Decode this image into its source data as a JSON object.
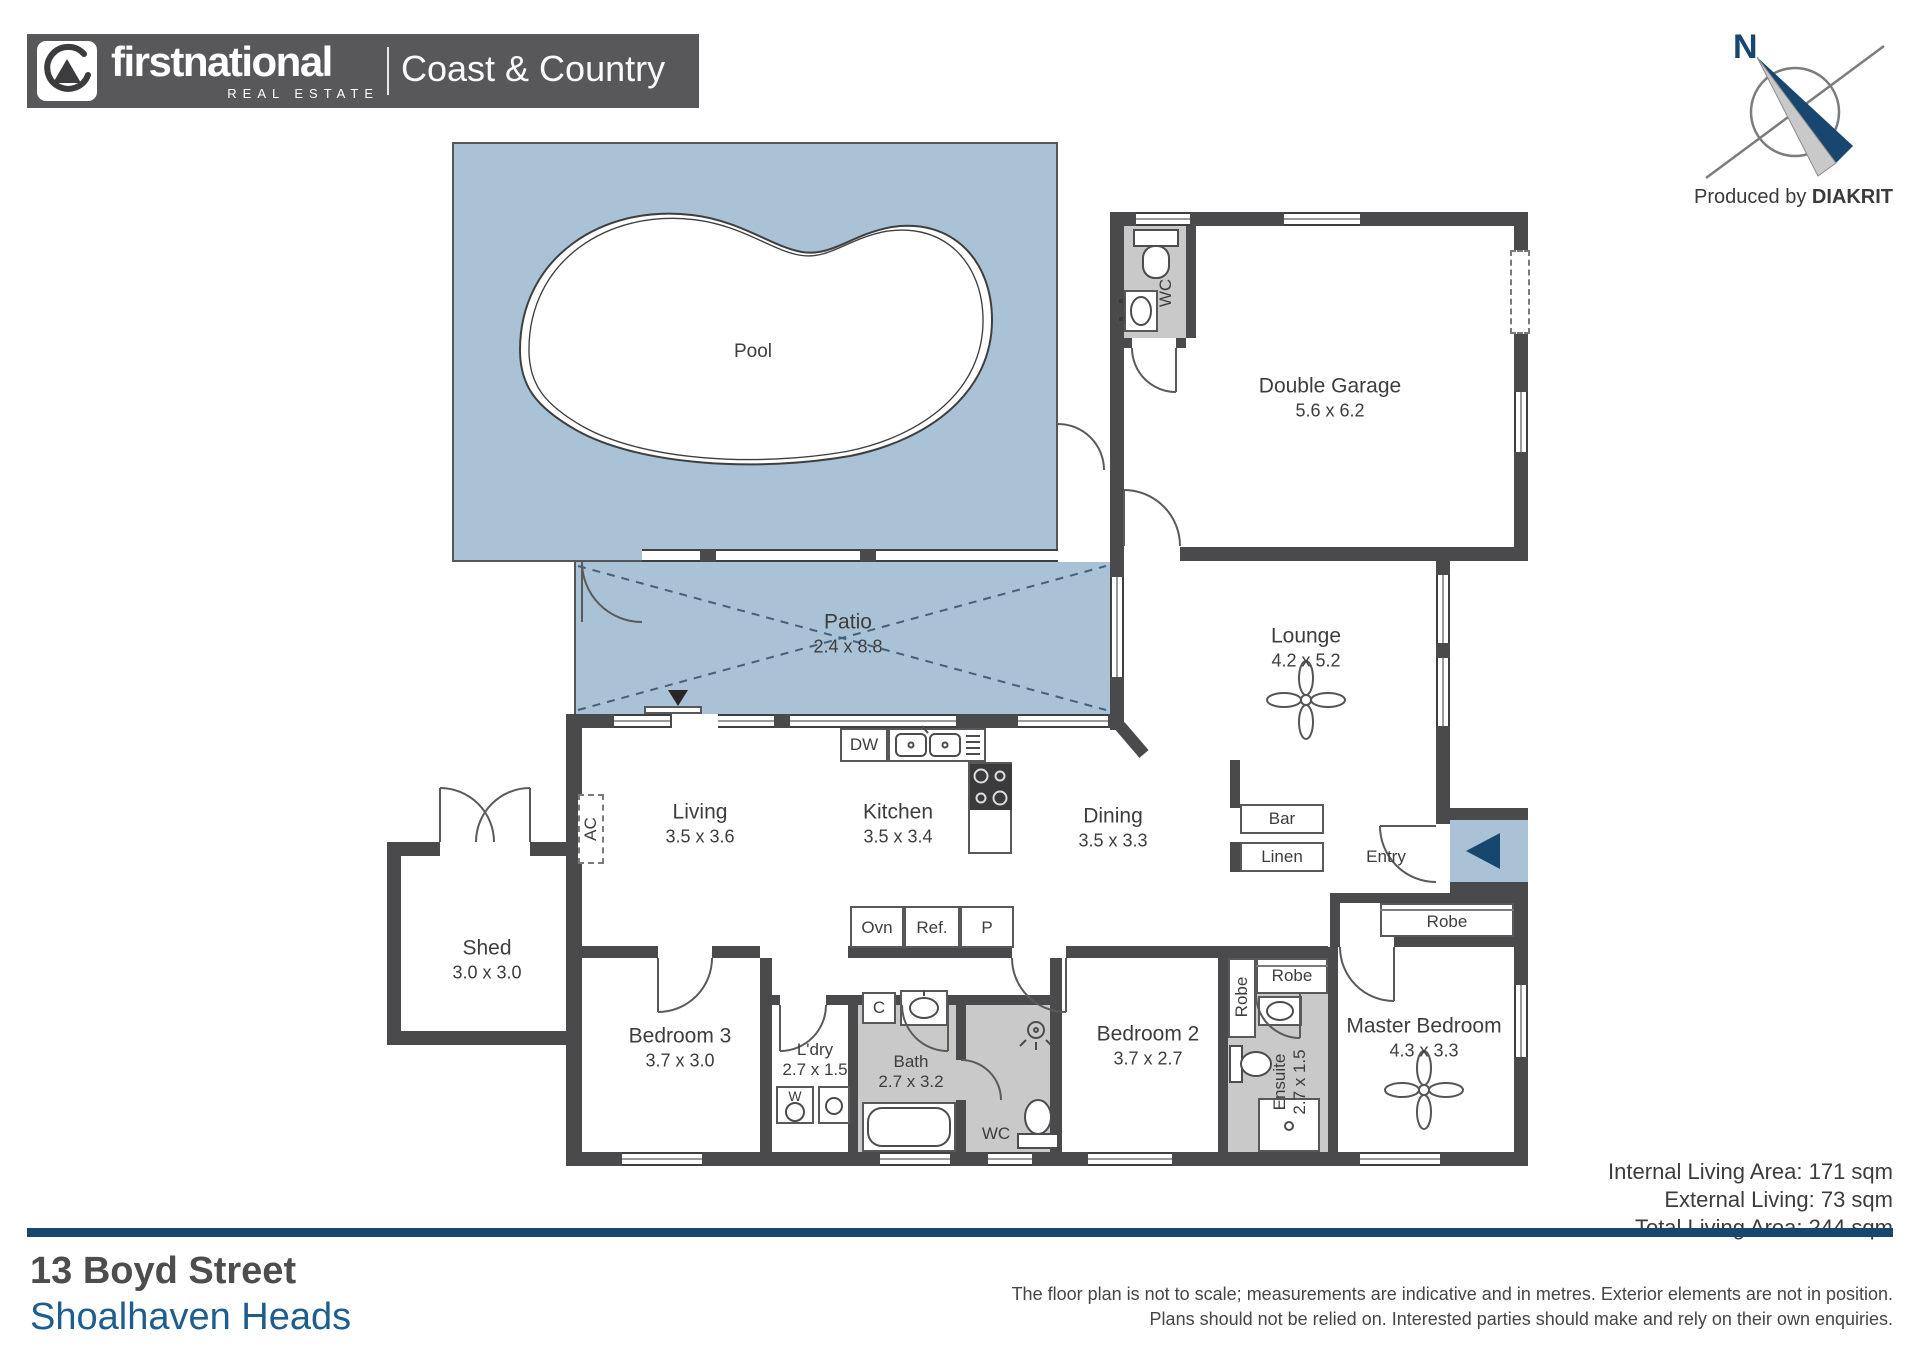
{
  "brand": {
    "name_bold": "firstnational",
    "name_sub": "REAL ESTATE",
    "office": "Coast & Country"
  },
  "compass": {
    "north": "N",
    "produced_by": "Produced by ",
    "producer": "DIAKRIT"
  },
  "plan": {
    "pool": {
      "label": "Pool"
    },
    "patio": {
      "label": "Patio",
      "dims": "2.4 x 8.8"
    },
    "garage": {
      "label": "Double Garage",
      "dims": "5.6 x 6.2"
    },
    "garage_wc": {
      "label": "WC"
    },
    "lounge": {
      "label": "Lounge",
      "dims": "4.2 x 5.2"
    },
    "living": {
      "label": "Living",
      "dims": "3.5 x 3.6"
    },
    "kitchen": {
      "label": "Kitchen",
      "dims": "3.5 x 3.4"
    },
    "dining": {
      "label": "Dining",
      "dims": "3.5 x 3.3"
    },
    "bar": {
      "label": "Bar"
    },
    "linen": {
      "label": "Linen"
    },
    "entry": {
      "label": "Entry"
    },
    "shed": {
      "label": "Shed",
      "dims": "3.0 x 3.0"
    },
    "bedroom3": {
      "label": "Bedroom 3",
      "dims": "3.7 x 3.0"
    },
    "laundry": {
      "label": "L'dry",
      "dims": "2.7 x 1.5"
    },
    "bath": {
      "label": "Bath",
      "dims": "2.7 x 3.2"
    },
    "wc": {
      "label": "WC"
    },
    "bedroom2": {
      "label": "Bedroom 2",
      "dims": "3.7 x 2.7"
    },
    "robe_bed2_side": {
      "label": "Robe"
    },
    "robe_bed2_top": {
      "label": "Robe"
    },
    "ensuite": {
      "label": "Ensuite",
      "dims": "2.7 x 1.5"
    },
    "master": {
      "label": "Master Bedroom",
      "dims": "4.3 x 3.3"
    },
    "robe_master": {
      "label": "Robe"
    },
    "appliances": {
      "ac": "AC",
      "dw": "DW",
      "oven": "Ovn",
      "fridge": "Ref.",
      "pantry": "P",
      "washer": "W",
      "cupboard": "C"
    }
  },
  "areas": {
    "internal": "Internal Living Area: 171 sqm",
    "external": "External Living: 73 sqm",
    "total": "Total Living Area: 244 sqm"
  },
  "address": {
    "street": "13 Boyd Street",
    "suburb": "Shoalhaven Heads"
  },
  "disclaimer": {
    "line1": "The floor plan is not to scale; measurements are indicative and in metres. Exterior elements are not in position.",
    "line2": "Plans should not be relied on. Interested parties should make and rely on their own enquiries."
  },
  "colors": {
    "accent_navy": "#17476e",
    "floor_blue": "#a9c2d6",
    "wall_gray": "#4a4a4c",
    "wet_area_gray": "#c9c9c9",
    "suburb_blue": "#1d5e8e"
  }
}
